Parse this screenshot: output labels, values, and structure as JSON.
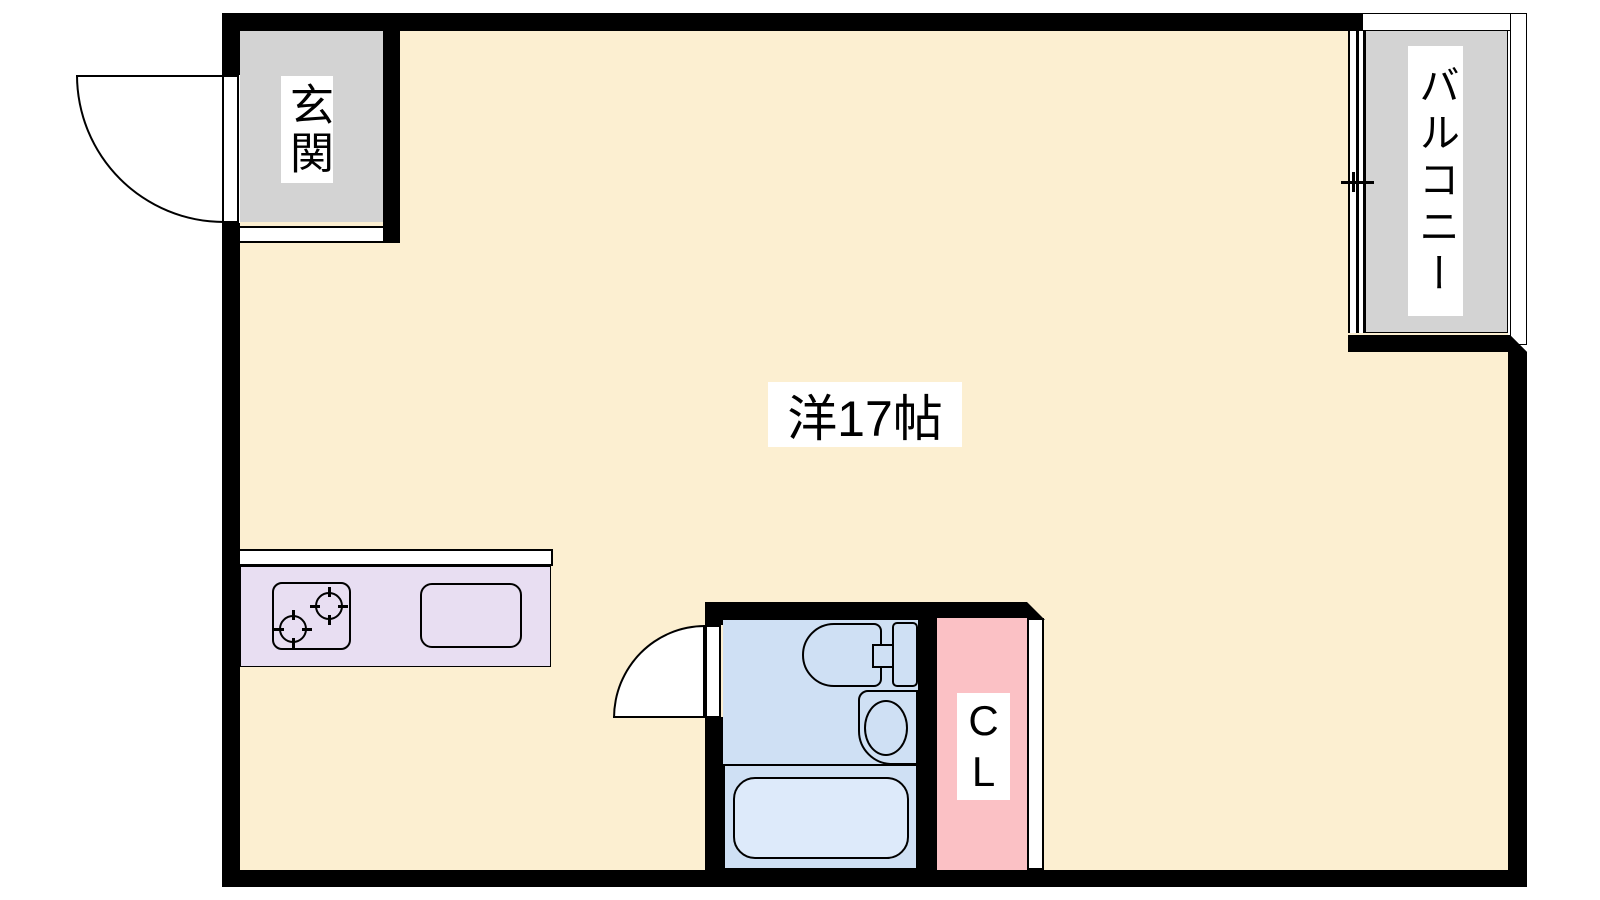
{
  "plan_title": "studio-apartment-floor-plan",
  "labels": {
    "entrance": "玄関",
    "balcony": "バルコニー",
    "living_room": "洋17帖",
    "closet": "C\nL"
  },
  "colors": {
    "wall": "#000000",
    "room_floor": "#fcefd1",
    "entrance_floor": "#d3d3d3",
    "balcony_floor": "#d3d3d3",
    "kitchen_counter": "#e8def2",
    "bathroom_floor": "#cfe0f4",
    "bathtub_fill": "#ddeafa",
    "closet_floor": "#fbc1c5",
    "line": "#000000",
    "background": "#ffffff",
    "label_bg": "#ffffff",
    "label_text": "#000000"
  },
  "fixtures": [
    "entrance-door-swing",
    "entrance-step",
    "balcony-sliding-window",
    "kitchen-counter",
    "stove",
    "stove-burner",
    "kitchen-sink",
    "bathroom-door-swing",
    "toilet",
    "washbasin",
    "bathtub",
    "closet-door"
  ]
}
